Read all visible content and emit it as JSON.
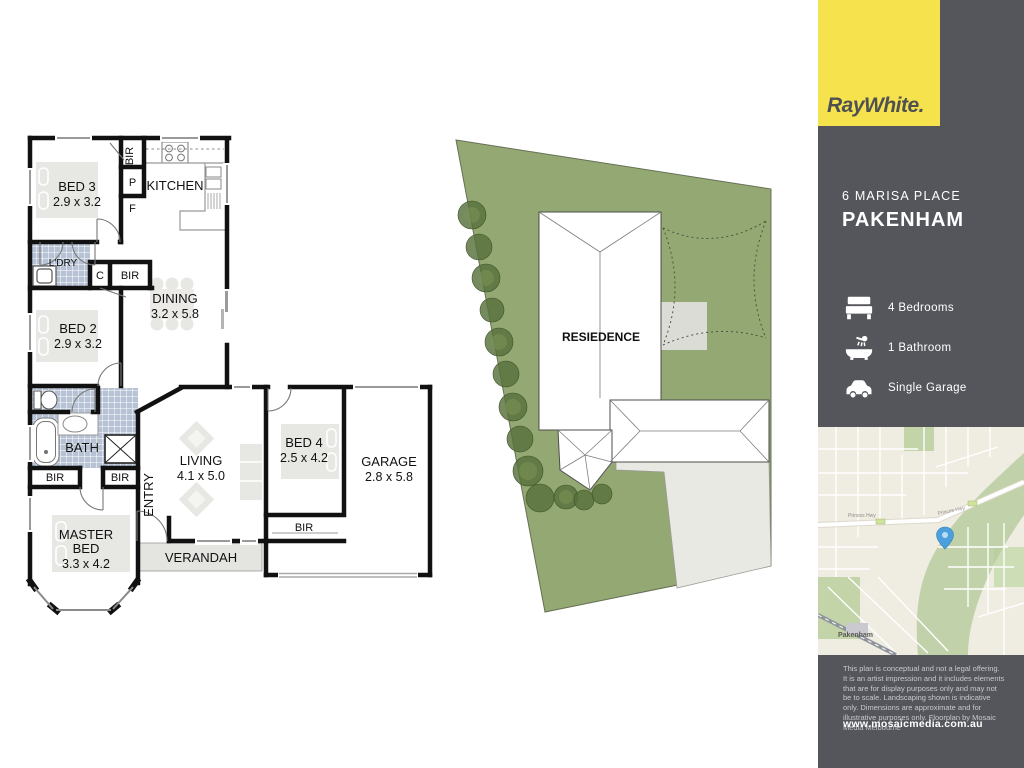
{
  "branding": {
    "logo": "RayWhite."
  },
  "colors": {
    "brand_yellow": "#f6e24d",
    "panel_dark": "#54565b",
    "site_green": "#94a873",
    "pin_blue": "#4aa0dc",
    "wall_black": "#111111",
    "tile_blue": "#b7c3d4",
    "furniture_gray": "#e7e7e3"
  },
  "listing": {
    "address_line1": "6 MARISA PLACE",
    "address_line2": "PAKENHAM",
    "features": [
      {
        "icon": "bed-icon",
        "label": "4 Bedrooms"
      },
      {
        "icon": "bath-icon",
        "label": "1 Bathroom"
      },
      {
        "icon": "car-icon",
        "label": "Single Garage"
      }
    ]
  },
  "floorplan": {
    "rooms": [
      {
        "name": "bed3",
        "label": "BED 3",
        "dims": "2.9 x 3.2"
      },
      {
        "name": "kitchen",
        "label": "KITCHEN"
      },
      {
        "name": "dining",
        "label": "DINING",
        "dims": "3.2 x 5.8"
      },
      {
        "name": "bed2",
        "label": "BED 2",
        "dims": "2.9 x 3.2"
      },
      {
        "name": "laundry",
        "label": "L'DRY"
      },
      {
        "name": "bath",
        "label": "BATH"
      },
      {
        "name": "living",
        "label": "LIVING",
        "dims": "4.1 x 5.0"
      },
      {
        "name": "entry",
        "label": "ENTRY"
      },
      {
        "name": "master",
        "lines": [
          "MASTER",
          "BED"
        ],
        "dims": "3.3 x 4.2"
      },
      {
        "name": "verandah",
        "label": "VERANDAH"
      },
      {
        "name": "bed4",
        "label": "BED 4",
        "dims": "2.5 x 4.2"
      },
      {
        "name": "garage",
        "label": "GARAGE",
        "dims": "2.8 x 5.8"
      }
    ],
    "closets": {
      "bir": "BIR",
      "pantry": "P",
      "fridge": "F",
      "cupboard": "C"
    }
  },
  "siteplan": {
    "residence_label": "RESIEDENCE"
  },
  "map": {
    "town_label": "Pakenham",
    "highway_label": "Princes Hwy"
  },
  "footer": {
    "disclaimer": "This plan is conceptual and not a legal offering. It is an artist impression and it includes elements that are for display purposes only and may not be to scale. Landscaping shown is indicative only. Dimensions are approximate and for illustrative purposes only. Floorplan by Mosaic Media Melbourne",
    "website": "www.mosaicmedia.com.au"
  }
}
